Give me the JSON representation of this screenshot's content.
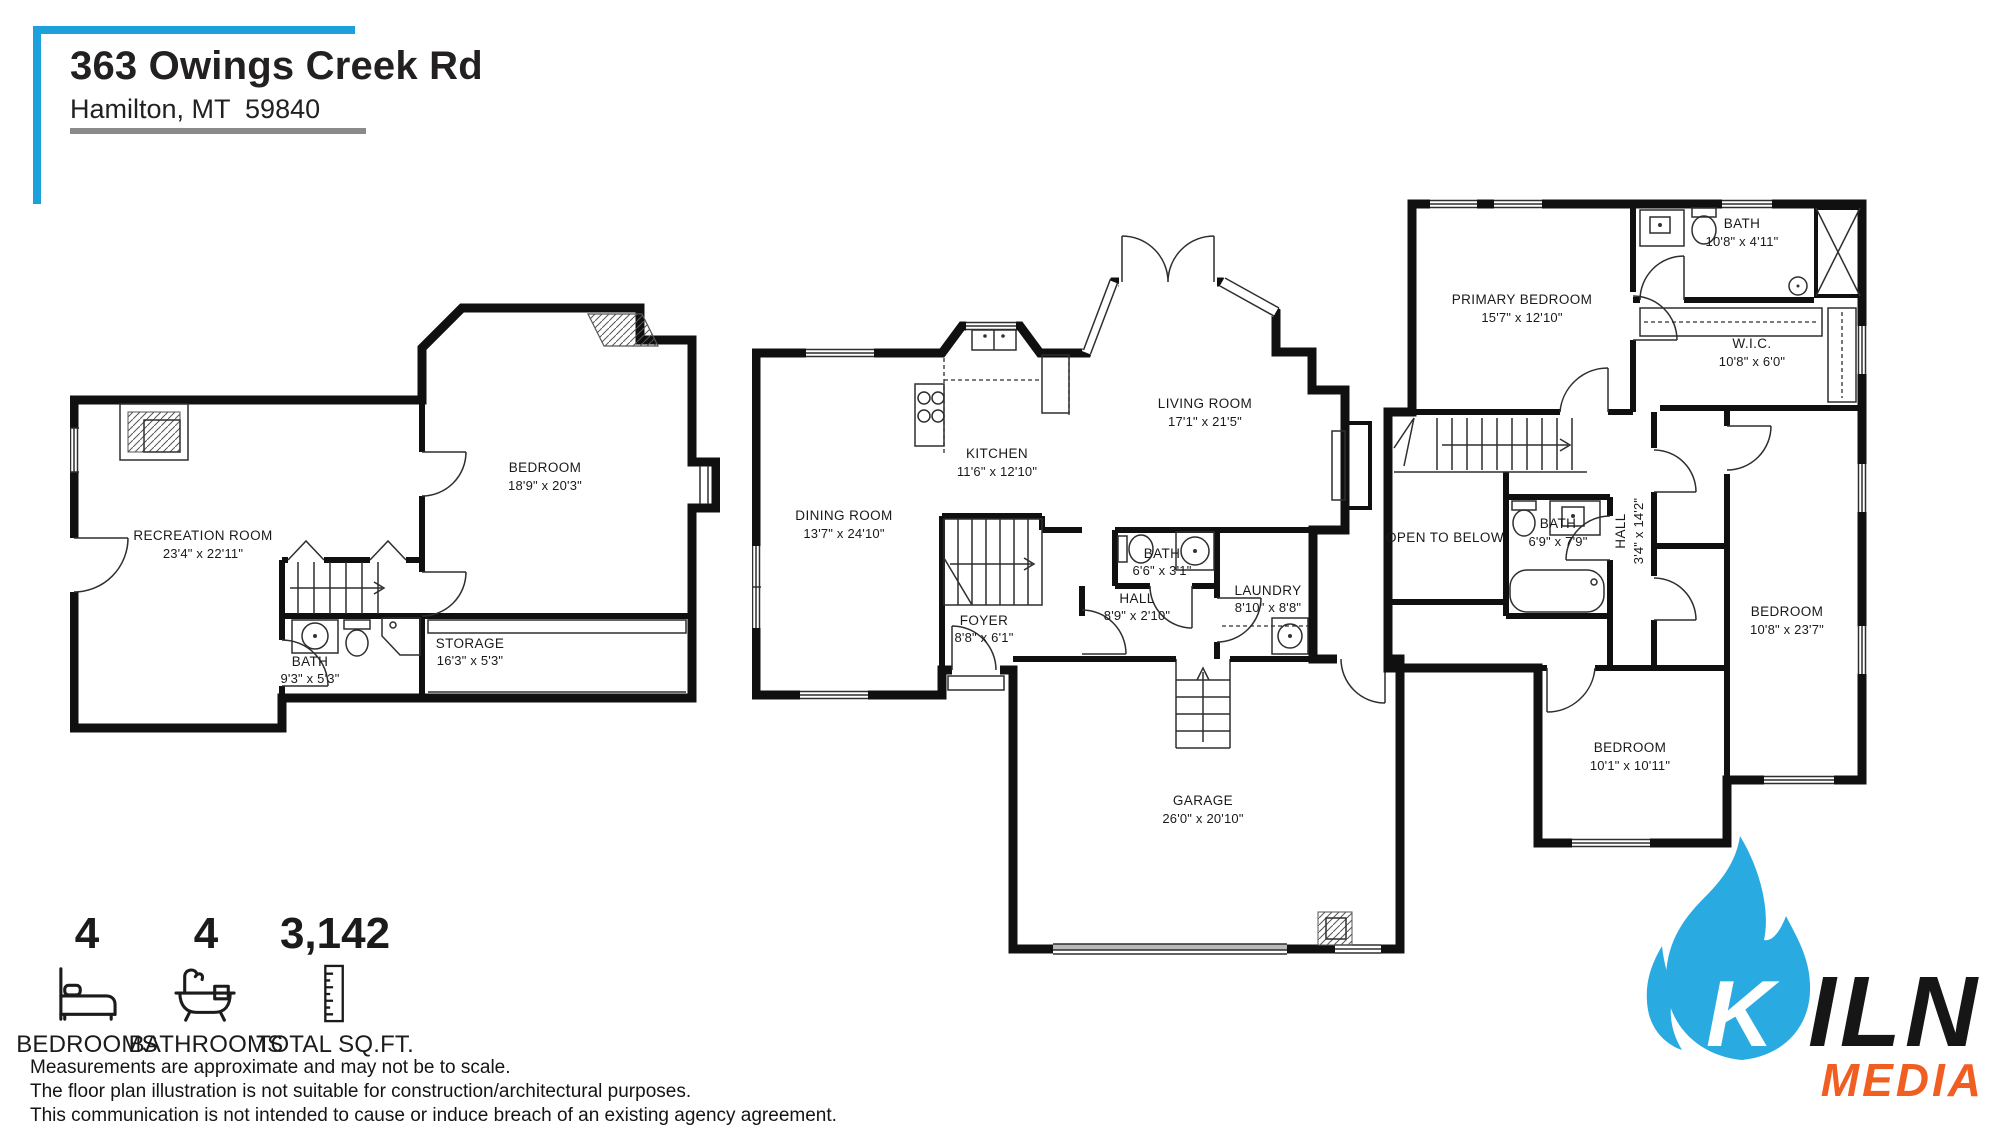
{
  "header": {
    "address_line1": "363 Owings Creek Rd",
    "address_line2": "Hamilton, MT  59840"
  },
  "plans": {
    "lower": {
      "recreation": {
        "name": "RECREATION ROOM",
        "dims": "23'4\" x 22'11\""
      },
      "bedroom": {
        "name": "BEDROOM",
        "dims": "18'9\" x 20'3\""
      },
      "bath": {
        "name": "BATH",
        "dims": "9'3\" x 5'3\""
      },
      "storage": {
        "name": "STORAGE",
        "dims": "16'3\" x 5'3\""
      }
    },
    "main": {
      "dining": {
        "name": "DINING ROOM",
        "dims": "13'7\" x 24'10\""
      },
      "kitchen": {
        "name": "KITCHEN",
        "dims": "11'6\" x 12'10\""
      },
      "living": {
        "name": "LIVING ROOM",
        "dims": "17'1\" x 21'5\""
      },
      "bath": {
        "name": "BATH",
        "dims": "6'6\" x 3'1\""
      },
      "hall": {
        "name": "HALL",
        "dims": "8'9\" x 2'10\""
      },
      "laundry": {
        "name": "LAUNDRY",
        "dims": "8'10\" x 8'8\""
      },
      "foyer": {
        "name": "FOYER",
        "dims": "8'8\" x 6'1\""
      },
      "garage": {
        "name": "GARAGE",
        "dims": "26'0\" x 20'10\""
      }
    },
    "upper": {
      "primary": {
        "name": "PRIMARY BEDROOM",
        "dims": "15'7\" x 12'10\""
      },
      "bath_top": {
        "name": "BATH",
        "dims": "10'8\" x 4'11\""
      },
      "wic": {
        "name": "W.I.C.",
        "dims": "10'8\" x 6'0\""
      },
      "open_below": {
        "name": "OPEN TO BELOW"
      },
      "bath_mid": {
        "name": "BATH",
        "dims": "6'9\" x 7'9\""
      },
      "hall": {
        "name": "HALL",
        "dims": "3'4\" x 14'2\""
      },
      "bedroom_right": {
        "name": "BEDROOM",
        "dims": "10'8\" x 23'7\""
      },
      "bedroom_left": {
        "name": "BEDROOM",
        "dims": "10'1\" x 10'11\""
      }
    }
  },
  "stats": {
    "bedrooms": {
      "value": "4",
      "label": "BEDROOMS"
    },
    "bathrooms": {
      "value": "4",
      "label": "BATHROOMS"
    },
    "sqft": {
      "value": "3,142",
      "label": "TOTAL SQ.FT."
    }
  },
  "disclaimer": {
    "line1": "Measurements are approximate and may not be to scale.",
    "line2": "The floor plan illustration is not suitable for construction/architectural purposes.",
    "line3": "This communication is not intended to cause or induce breach of an existing agency agreement."
  },
  "logo": {
    "k": "K",
    "iln": "ILN",
    "media": "MEDIA",
    "flame_color": "#29ABE2",
    "media_color": "#F15E22",
    "text_color": "#161616"
  },
  "colors": {
    "accent_blue": "#1DA1DC",
    "underline_gray": "#8A8A8A"
  }
}
